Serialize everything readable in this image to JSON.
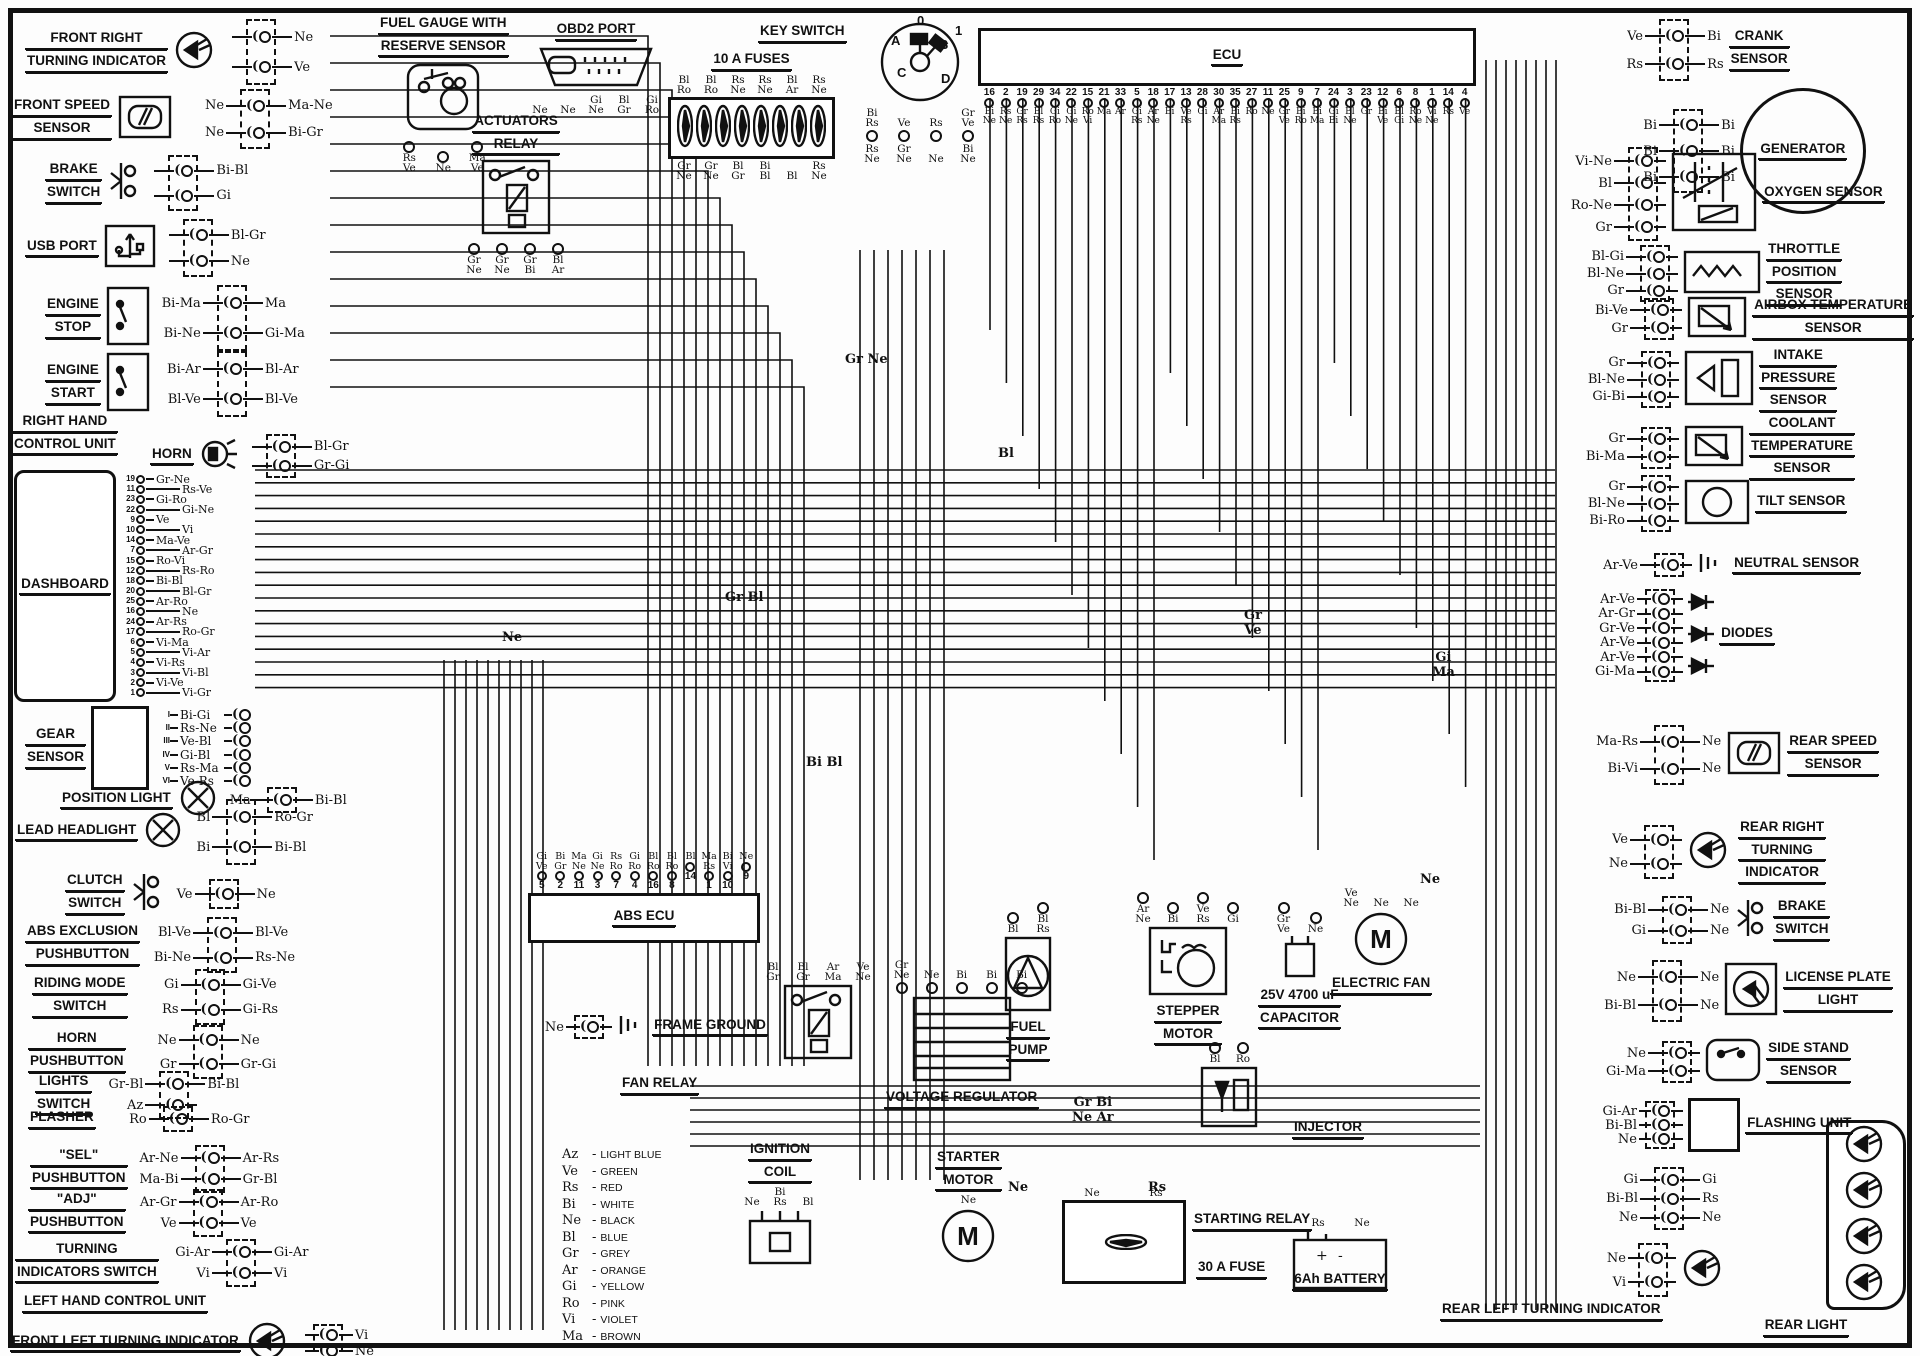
{
  "diagram": {
    "type": "motorcycle-wiring-diagram"
  },
  "components": {
    "front_right_turning_indicator": {
      "label": [
        "FRONT RIGHT",
        "TURNING INDICATOR"
      ],
      "wires": [
        [
          "",
          "Ne"
        ],
        [
          "",
          "Ve"
        ]
      ]
    },
    "front_speed_sensor": {
      "label": [
        "FRONT SPEED",
        "SENSOR"
      ],
      "wires": [
        [
          "Ne",
          "Ma-Ne"
        ],
        [
          "Ne",
          "Bi-Gr"
        ]
      ]
    },
    "brake_switch_front": {
      "label": [
        "BRAKE",
        "SWITCH"
      ],
      "wires": [
        [
          "",
          "Bi-Bl"
        ],
        [
          "",
          "Gi"
        ]
      ]
    },
    "usb_port": {
      "label": [
        "USB PORT"
      ],
      "wires": [
        [
          "",
          "Bl-Gr"
        ],
        [
          "",
          "Ne"
        ]
      ]
    },
    "engine_stop": {
      "label": [
        "ENGINE",
        "STOP"
      ],
      "wires": [
        [
          "Bi-Ma",
          "Ma"
        ],
        [
          "Bi-Ne",
          "Gi-Ma"
        ]
      ]
    },
    "engine_start": {
      "label": [
        "ENGINE",
        "START"
      ],
      "wires": [
        [
          "Bi-Ar",
          "Bl-Ar"
        ],
        [
          "Bl-Ve",
          "Bl-Ve"
        ]
      ]
    },
    "right_hand_control_unit": {
      "label": [
        "RIGHT HAND",
        "CONTROL UNIT"
      ]
    },
    "horn": {
      "label": [
        "HORN"
      ],
      "wires": [
        [
          "",
          "Bl-Gr"
        ],
        [
          "",
          "Gr-Gi"
        ]
      ]
    },
    "dashboard": {
      "label": [
        "DASHBOARD"
      ],
      "pins": [
        "19",
        "11",
        "23",
        "22",
        "9",
        "10",
        "14",
        "7",
        "15",
        "12",
        "18",
        "20",
        "25",
        "16",
        "24",
        "17",
        "6",
        "5",
        "4",
        "3",
        "2",
        "1"
      ],
      "wire_labels": [
        "Gr-Ne",
        "Rs-Ve",
        "Gi-Ro",
        "Gi-Ne",
        "Ve",
        "Vi",
        "Ma-Ve",
        "Ar-Gr",
        "Ro-Vi",
        "Rs-Ro",
        "Bi-Bl",
        "Bl-Gr",
        "Ar-Ro",
        "Ne",
        "Ar-Rs",
        "Ro-Gr",
        "Vi-Ma",
        "Vi-Ar",
        "Vi-Rs",
        "Vi-Bl",
        "Vi-Ve",
        "Vi-Gr"
      ]
    },
    "gear_sensor": {
      "label": [
        "GEAR",
        "SENSOR"
      ],
      "pins": [
        "I",
        "II",
        "III",
        "IV",
        "V",
        "VI"
      ],
      "wire_labels": [
        "Bi-Gi",
        "Rs-Ne",
        "Ve-Bl",
        "Gi-Bl",
        "Rs-Ma",
        "Ve-Rs"
      ]
    },
    "position_light": {
      "label": [
        "POSITION LIGHT"
      ],
      "wires": [
        [
          "Ma",
          "Bi-Bl"
        ]
      ]
    },
    "lead_headlight": {
      "label": [
        "LEAD HEADLIGHT"
      ],
      "wires": [
        [
          "Bl",
          "Ro-Gr"
        ],
        [
          "Bi",
          "Bi-Bl"
        ]
      ]
    },
    "clutch_switch": {
      "label": [
        "CLUTCH",
        "SWITCH"
      ],
      "wires": [
        [
          "Ve",
          "Ne"
        ]
      ]
    },
    "abs_exclusion_pushbutton": {
      "label": [
        "ABS EXCLUSION",
        "PUSHBUTTON"
      ],
      "wires": [
        [
          "Bl-Ve",
          "Bl-Ve"
        ],
        [
          "Bi-Ne",
          "Rs-Ne"
        ]
      ]
    },
    "riding_mode_switch": {
      "label": [
        "RIDING MODE",
        "SWITCH"
      ],
      "wires": [
        [
          "Gi",
          "Gi-Ve"
        ],
        [
          "Rs",
          "Gi-Rs"
        ]
      ]
    },
    "horn_pushbutton": {
      "label": [
        "HORN",
        "PUSHBUTTON"
      ],
      "wires": [
        [
          "Ne",
          "Ne"
        ],
        [
          "Gr",
          "Gr-Gi"
        ]
      ]
    },
    "lights_switch": {
      "label": [
        "LIGHTS",
        "SWITCH"
      ],
      "wires": [
        [
          "Gr-Bl",
          "Bi-Bl"
        ],
        [
          "Az",
          ""
        ]
      ]
    },
    "flasher": {
      "label": [
        "FLASHER"
      ],
      "wires": [
        [
          "Ro",
          "Ro-Gr"
        ]
      ]
    },
    "sel_pushbutton": {
      "label": [
        "\"SEL\"",
        "PUSHBUTTON"
      ],
      "wires": [
        [
          "Ar-Ne",
          "Ar-Rs"
        ],
        [
          "Ma-Bi",
          "Gr-Bl"
        ]
      ]
    },
    "adj_pushbutton": {
      "label": [
        "\"ADJ\"",
        "PUSHBUTTON"
      ],
      "wires": [
        [
          "Ar-Gr",
          "Ar-Ro"
        ],
        [
          "Ve",
          "Ve"
        ]
      ]
    },
    "turning_indicators_switch": {
      "label": [
        "TURNING",
        "INDICATORS SWITCH"
      ],
      "wires": [
        [
          "Gi-Ar",
          "Gi-Ar"
        ],
        [
          "Vi",
          "Vi"
        ]
      ]
    },
    "left_hand_control_unit": {
      "label": [
        "LEFT HAND CONTROL UNIT"
      ]
    },
    "front_left_turning_indicator": {
      "label": [
        "FRONT LEFT TURNING INDICATOR"
      ],
      "wires": [
        [
          "",
          "Vi"
        ],
        [
          "",
          "Ne"
        ]
      ]
    },
    "fuel_gauge": {
      "label": [
        "FUEL GAUGE WITH",
        "RESERVE SENSOR"
      ],
      "wire_labels": [
        "Rs-Ve",
        "Ne",
        "Ma-Ve"
      ]
    },
    "actuators_relay": {
      "label": [
        "ACTUATORS",
        "RELAY"
      ],
      "wire_labels": [
        "Gr-Ne",
        "Gr-Ne",
        "Gr-Bi",
        "Bl-Ar"
      ]
    },
    "obd2_port": {
      "label": [
        "OBD2 PORT"
      ],
      "wire_labels": [
        "Ne",
        "Ne",
        "Gi-Ne",
        "Bl-Gr",
        "Gi-Ro"
      ]
    },
    "fuses_10a": {
      "label": [
        "10 A FUSES"
      ],
      "top_labels": [
        "Bl-Ro",
        "Bl-Ro",
        "Rs-Ne",
        "Rs-Ne",
        "Bl-Ar",
        "Rs-Ne"
      ],
      "bottom_labels": [
        "Gr-Ne",
        "Gr-Ne",
        "Bl-Gr",
        "Bi-Bl",
        "Bl",
        "Rs-Ne"
      ]
    },
    "key_switch": {
      "label": [
        "KEY SWITCH"
      ],
      "positions": [
        "0",
        "1",
        "A",
        "B",
        "C",
        "D"
      ],
      "upper_wires": [
        "Bi-Rs",
        "Ve",
        "Rs",
        "Gr-Ve"
      ],
      "lower_wires": [
        "Rs-Ne",
        "Gr-Ne",
        "Ne",
        "Bi-Ne"
      ]
    },
    "ecu": {
      "label": [
        "ECU"
      ],
      "pins": [
        "16",
        "2",
        "19",
        "29",
        "34",
        "22",
        "15",
        "21",
        "33",
        "5",
        "18",
        "17",
        "13",
        "28",
        "30",
        "35",
        "27",
        "11",
        "25",
        "9",
        "7",
        "24",
        "3",
        "23",
        "12",
        "6",
        "8",
        "1",
        "14",
        "4"
      ],
      "wire_labels": [
        "Bi-Ne",
        "Rs-Ne",
        "Gr-Rs",
        "Bl-Rs",
        "Gi-Ro",
        "Gi-Ne",
        "Ro-Vi",
        "Ma",
        "Ar",
        "Gi-Rs",
        "Ar-Ne",
        "Bi",
        "Ve-Rs",
        "Gi",
        "Ar-Ma",
        "Bi-Rs",
        "Ro",
        "Ne",
        "Gr-Ve",
        "Bi-Ro",
        "Bi-Ma",
        "Gi-Bi",
        "Bl-Ne",
        "Gr",
        "Bi-Ve",
        "Bl-Gi",
        "Ro-Ne",
        "Vi-Ne",
        "Rs",
        "Ve"
      ]
    },
    "crank_sensor": {
      "label": [
        "CRANK",
        "SENSOR"
      ],
      "wires": [
        [
          "Ve",
          "Bi"
        ],
        [
          "Rs",
          "Rs"
        ]
      ]
    },
    "generator": {
      "label": [
        "GENERATOR"
      ],
      "wires": [
        [
          "Bi",
          "Bi"
        ],
        [
          "Bi",
          "Bi"
        ],
        [
          "Bi",
          "Bi"
        ]
      ]
    },
    "oxygen_sensor": {
      "label": [
        "OXYGEN SENSOR"
      ],
      "wires": [
        [
          "Vi-Ne",
          ""
        ],
        [
          "Bl",
          ""
        ],
        [
          "Ro-Ne",
          ""
        ],
        [
          "Gr",
          ""
        ]
      ]
    },
    "throttle_position_sensor": {
      "label": [
        "THROTTLE",
        "POSITION",
        "SENSOR"
      ],
      "wires": [
        [
          "Bl-Gi",
          ""
        ],
        [
          "Bl-Ne",
          ""
        ],
        [
          "Gr",
          ""
        ]
      ]
    },
    "airbox_temperature_sensor": {
      "label": [
        "AIRBOX TEMPERATURE",
        "SENSOR"
      ],
      "wires": [
        [
          "Bi-Ve",
          ""
        ],
        [
          "Gr",
          ""
        ]
      ]
    },
    "intake_pressure_sensor": {
      "label": [
        "INTAKE",
        "PRESSURE",
        "SENSOR"
      ],
      "wires": [
        [
          "Gr",
          ""
        ],
        [
          "Bl-Ne",
          ""
        ],
        [
          "Gi-Bi",
          ""
        ]
      ]
    },
    "coolant_temperature_sensor": {
      "label": [
        "COOLANT",
        "TEMPERATURE",
        "SENSOR"
      ],
      "wires": [
        [
          "Gr",
          ""
        ],
        [
          "Bi-Ma",
          ""
        ]
      ]
    },
    "tilt_sensor": {
      "label": [
        "TILT SENSOR"
      ],
      "wires": [
        [
          "Gr",
          ""
        ],
        [
          "Bl-Ne",
          ""
        ],
        [
          "Bi-Ro",
          ""
        ]
      ]
    },
    "neutral_sensor": {
      "label": [
        "NEUTRAL SENSOR"
      ],
      "wires": [
        [
          "Ar-Ve",
          ""
        ]
      ]
    },
    "diodes": {
      "label": [
        "DIODES"
      ],
      "wires": [
        [
          "Ar-Ve",
          ""
        ],
        [
          "Ar-Gr",
          ""
        ],
        [
          "Gr-Ve",
          ""
        ],
        [
          "Ar-Ve",
          ""
        ],
        [
          "Ar-Ve",
          ""
        ],
        [
          "Gi-Ma",
          ""
        ]
      ]
    },
    "rear_speed_sensor": {
      "label": [
        "REAR SPEED",
        "SENSOR"
      ],
      "wires": [
        [
          "Ma-Rs",
          "Ne"
        ],
        [
          "Bi-Vi",
          "Ne"
        ]
      ]
    },
    "rear_right_turning_indicator": {
      "label": [
        "REAR RIGHT",
        "TURNING",
        "INDICATOR"
      ],
      "wires": [
        [
          "Ve",
          ""
        ],
        [
          "Ne",
          ""
        ]
      ]
    },
    "brake_switch_rear": {
      "label": [
        "BRAKE",
        "SWITCH"
      ],
      "wires": [
        [
          "Bi-Bl",
          "Ne"
        ],
        [
          "Gi",
          "Ne"
        ]
      ]
    },
    "license_plate_light": {
      "label": [
        "LICENSE PLATE",
        "LIGHT"
      ],
      "wires": [
        [
          "Ne",
          "Ne"
        ],
        [
          "Bi-Bl",
          "Ne"
        ]
      ]
    },
    "side_stand_sensor": {
      "label": [
        "SIDE STAND",
        "SENSOR"
      ],
      "wires": [
        [
          "Ne",
          ""
        ],
        [
          "Gi-Ma",
          ""
        ]
      ]
    },
    "flashing_unit": {
      "label": [
        "FLASHING UNIT"
      ],
      "wires": [
        [
          "Gi-Ar",
          ""
        ],
        [
          "Bi-Bl",
          ""
        ],
        [
          "Ne",
          ""
        ]
      ]
    },
    "rear_light": {
      "label": [
        "REAR LIGHT"
      ],
      "wires": [
        [
          "Gi",
          "Gi"
        ],
        [
          "Bi-Bl",
          "Rs"
        ],
        [
          "Ne",
          "Ne"
        ]
      ]
    },
    "rear_left_turning_indicator": {
      "label": [
        "REAR LEFT TURNING INDICATOR"
      ],
      "wires": [
        [
          "Ne",
          ""
        ],
        [
          "Vi",
          ""
        ]
      ]
    },
    "abs_ecu": {
      "label": [
        "ABS ECU"
      ],
      "pins": [
        "5",
        "2",
        "11",
        "3",
        "7",
        "4",
        "16",
        "8",
        "14",
        "1",
        "10",
        "9"
      ],
      "wire_labels": [
        "Gi-Ve",
        "Bi-Gr",
        "Ma-Ne",
        "Gi-Ne",
        "Rs-Ro",
        "Gi-Ro",
        "Bl-Ro",
        "Bl-Ro",
        "Bl",
        "Ma-Rs",
        "Bi-Vi",
        "Ne"
      ]
    },
    "frame_ground": {
      "label": [
        "FRAME GROUND"
      ],
      "wires": [
        [
          "Ne",
          ""
        ]
      ]
    },
    "fan_relay": {
      "label": [
        "FAN RELAY"
      ],
      "wire_labels": [
        "Bl-Gr",
        "Bl-Gr",
        "Ar-Ma",
        "Ve-Ne"
      ]
    },
    "ignition_coil": {
      "label": [
        "IGNITION",
        "COIL"
      ],
      "wire_labels": [
        "Ne",
        "Bi-Rs",
        "Bl"
      ]
    },
    "voltage_regulator": {
      "label": [
        "VOLTAGE REGULATOR"
      ],
      "wire_labels": [
        "Gr-Ne",
        "Ne",
        "Bi",
        "Bi",
        "Bi"
      ]
    },
    "fuel_pump": {
      "label": [
        "FUEL",
        "PUMP"
      ],
      "wire_labels": [
        "Bl",
        "Bl-Rs"
      ]
    },
    "stepper_motor": {
      "label": [
        "STEPPER",
        "MOTOR"
      ],
      "wire_labels": [
        "Ar-Ne",
        "Bi",
        "Ve-Rs",
        "Gi"
      ]
    },
    "electric_fan": {
      "label": [
        "ELECTRIC FAN"
      ],
      "wire_labels": [
        "Ve-Ne",
        "Ne",
        "Ne"
      ]
    },
    "capacitor": {
      "label": [
        "25V 4700 uF",
        "CAPACITOR"
      ],
      "wire_labels": [
        "Gr-Ve",
        "Ne"
      ],
      "terminals": [
        "+",
        "-"
      ]
    },
    "injector": {
      "label": [
        "INJECTOR"
      ],
      "wire_labels": [
        "Bl",
        "Ro"
      ]
    },
    "starter_motor": {
      "label": [
        "STARTER",
        "MOTOR"
      ],
      "wire_labels": [
        "Ne"
      ]
    },
    "starting_relay": {
      "label": [
        "STARTING RELAY"
      ],
      "wire_labels": [
        "Ne",
        "Rs"
      ]
    },
    "fuse_30a": {
      "label": [
        "30 A FUSE"
      ]
    },
    "battery": {
      "label": [
        "6Ah BATTERY"
      ],
      "terminals": [
        "+",
        "-"
      ],
      "wire_labels": [
        "Rs",
        "Ne"
      ]
    }
  },
  "legend": [
    {
      "code": "Az",
      "color": "LIGHT BLUE"
    },
    {
      "code": "Ve",
      "color": "GREEN"
    },
    {
      "code": "Rs",
      "color": "RED"
    },
    {
      "code": "Bi",
      "color": "WHITE"
    },
    {
      "code": "Ne",
      "color": "BLACK"
    },
    {
      "code": "Bl",
      "color": "BLUE"
    },
    {
      "code": "Gr",
      "color": "GREY"
    },
    {
      "code": "Ar",
      "color": "ORANGE"
    },
    {
      "code": "Gi",
      "color": "YELLOW"
    },
    {
      "code": "Ro",
      "color": "PINK"
    },
    {
      "code": "Vi",
      "color": "VIOLET"
    },
    {
      "code": "Ma",
      "color": "BROWN"
    }
  ],
  "junction_labels": [
    "Gr Ne",
    "Bl",
    "Gr Bl",
    "Ne",
    "Bi Bl",
    "Gr\nVe",
    "Gi\nMa",
    "Gr Bi\nNe Ar",
    "Ne",
    "Ne",
    "Rs"
  ]
}
